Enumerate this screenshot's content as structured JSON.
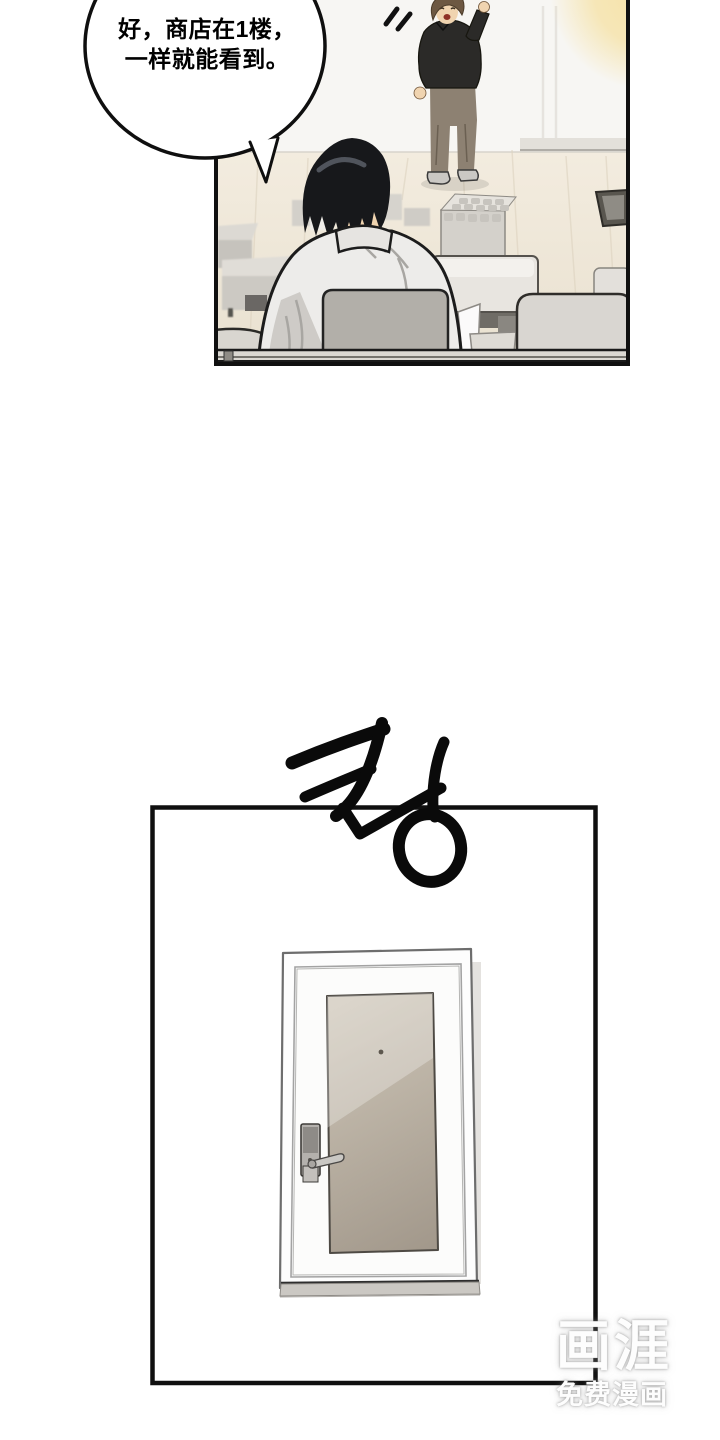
{
  "page": {
    "width": 720,
    "height": 1440,
    "background": "#ffffff"
  },
  "panel_top": {
    "speech_bubble": {
      "line1": "好，商店在1楼，",
      "line2": "一样就能看到。"
    }
  },
  "sfx": {
    "text": "쾅"
  },
  "watermark": {
    "logo": "画涯",
    "tagline": "免费漫画"
  },
  "colors": {
    "panel_border": "#101010",
    "wall": "#f7f6f3",
    "floor_light": "#f3ecdf",
    "floor_dark": "#e9e1d0",
    "lamp_glow": "#f6e1a3",
    "shirt_seated": "#edecea",
    "hair_seated": "#17181b",
    "sweater_standing": "#2b2a28",
    "pants_standing": "#8d8172",
    "hair_standing": "#6d5842",
    "skin": "#f0d4b0",
    "door_panel_light": "#cdc5b7",
    "door_panel_dark": "#a2988b",
    "furniture_gray": "#d6d3cd"
  }
}
